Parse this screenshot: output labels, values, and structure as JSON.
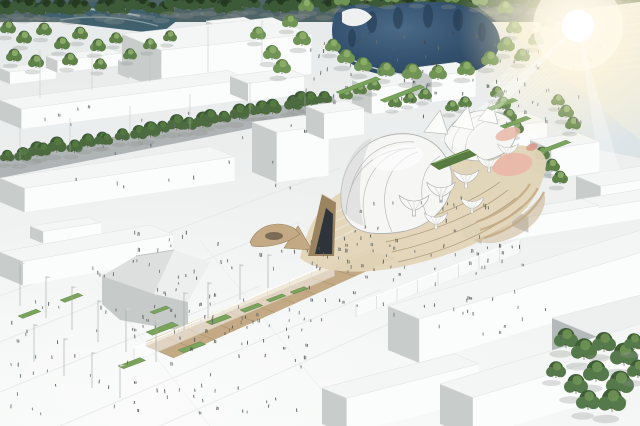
{
  "meta": {
    "title": "Aerial architectural rendering: expo masterplan with organic membrane-and-timber pavilion, pond and white massing buildings",
    "visible_text": []
  },
  "palette": {
    "groundTop": "#e9eceb",
    "groundBottom": "#f5f7f6",
    "backdrop": "#4f6468",
    "river": "#41606e",
    "pond": "#33516e",
    "pondDeep": "#22374d",
    "pondEdge": "#6d88a0",
    "faceTop": "#f4f6f5",
    "faceFront": "#fbfcfc",
    "faceSide": "#c8cdcc",
    "streetDark": "#7e8486",
    "wood": "#c3aa85",
    "woodDark": "#99845f",
    "woodLight": "#e2d4b6",
    "shell": "#f6f6f4",
    "shellLine": "#aeb2b0",
    "glassDark": "#26323e",
    "pink": "#e9b7a8",
    "pinkDark": "#d99485",
    "grass": "#7aa35b",
    "grassDark": "#567c41",
    "treeDark": "#2c432e",
    "tree": "#3d5a38",
    "treeMid": "#4c6b40",
    "treeLight": "#5d8148",
    "treeHi": "#8fb06a",
    "person": "#4a4e50",
    "sunGlow": "#fff3cf",
    "pole": "#9fa5a4"
  },
  "scene": {
    "seed": 11,
    "sun": {
      "x": 578,
      "y": 26
    },
    "tree_bands": [
      {
        "x1": 0,
        "y1": 15,
        "x2": 640,
        "y2": 6,
        "count": 56,
        "rmin": 7,
        "rmax": 12,
        "jy": 7,
        "colors": [
          "#2c432e",
          "#3d5a38",
          "#24381f"
        ]
      },
      {
        "x1": 6,
        "y1": 164,
        "x2": 334,
        "y2": 102,
        "count": 26,
        "rmin": 7,
        "rmax": 10,
        "jy": 4,
        "colors": [
          "#3d5a38",
          "#4c6b40",
          "#567c41"
        ]
      }
    ],
    "lawn_trees": [
      [
        8,
        34,
        8
      ],
      [
        24,
        44,
        8
      ],
      [
        44,
        36,
        8
      ],
      [
        62,
        50,
        8
      ],
      [
        80,
        40,
        8
      ],
      [
        98,
        52,
        8
      ],
      [
        116,
        44,
        7
      ],
      [
        14,
        62,
        8
      ],
      [
        36,
        68,
        8
      ],
      [
        70,
        66,
        8
      ],
      [
        100,
        70,
        7
      ],
      [
        130,
        60,
        7
      ],
      [
        150,
        50,
        7
      ],
      [
        170,
        42,
        7
      ]
    ],
    "pond_trees": [
      [
        333,
        52,
        8
      ],
      [
        346,
        64,
        9
      ],
      [
        363,
        72,
        9
      ],
      [
        386,
        77,
        9
      ],
      [
        412,
        80,
        10
      ],
      [
        438,
        80,
        9
      ],
      [
        466,
        76,
        9
      ],
      [
        490,
        66,
        9
      ],
      [
        506,
        52,
        9
      ],
      [
        514,
        34,
        8
      ],
      [
        505,
        14,
        8
      ],
      [
        480,
        6,
        8
      ],
      [
        452,
        3,
        8
      ],
      [
        420,
        2,
        8
      ],
      [
        392,
        3,
        8
      ],
      [
        366,
        2,
        8
      ],
      [
        342,
        6,
        8
      ],
      [
        302,
        46,
        9
      ],
      [
        290,
        28,
        8
      ],
      [
        306,
        12,
        8
      ],
      [
        272,
        60,
        9
      ],
      [
        258,
        40,
        8
      ],
      [
        282,
        74,
        9
      ],
      [
        522,
        62,
        8
      ],
      [
        536,
        46,
        8
      ],
      [
        548,
        28,
        8
      ]
    ],
    "roofline_trees": [
      [
        497,
        98,
        7
      ],
      [
        503,
        110,
        8
      ],
      [
        509,
        122,
        8
      ],
      [
        516,
        134,
        8
      ],
      [
        558,
        106,
        7
      ],
      [
        566,
        118,
        8
      ],
      [
        573,
        130,
        8
      ],
      [
        542,
        160,
        8
      ],
      [
        552,
        172,
        8
      ],
      [
        560,
        184,
        8
      ]
    ],
    "mid_trees": [
      [
        346,
        100,
        7
      ],
      [
        360,
        95,
        7
      ],
      [
        374,
        91,
        7
      ],
      [
        395,
        108,
        7
      ],
      [
        410,
        104,
        7
      ],
      [
        425,
        100,
        7
      ],
      [
        452,
        112,
        7
      ],
      [
        465,
        108,
        7
      ]
    ],
    "corner_trees": [
      [
        566,
        348,
        12
      ],
      [
        584,
        360,
        13
      ],
      [
        604,
        352,
        12
      ],
      [
        624,
        366,
        14
      ],
      [
        596,
        382,
        13
      ],
      [
        576,
        394,
        12
      ],
      [
        620,
        394,
        14
      ],
      [
        638,
        378,
        11
      ],
      [
        556,
        378,
        10
      ],
      [
        634,
        350,
        10
      ],
      [
        612,
        412,
        14
      ],
      [
        588,
        410,
        12
      ]
    ],
    "buildings_back": [
      [
        0,
        68,
        46,
        12,
        12,
        -0.12
      ],
      [
        46,
        56,
        64,
        14,
        12,
        -0.12
      ],
      [
        118,
        60,
        92,
        14,
        14,
        -0.12
      ],
      [
        176,
        30,
        28,
        16,
        13,
        -0.1
      ],
      [
        206,
        21,
        38,
        20,
        17,
        -0.1
      ],
      [
        122,
        34,
        150,
        48,
        40,
        -0.11
      ],
      [
        352,
        80,
        46,
        24,
        26,
        -0.13
      ],
      [
        412,
        68,
        44,
        24,
        26,
        -0.13
      ],
      [
        466,
        120,
        58,
        28,
        34,
        -0.15
      ],
      [
        530,
        140,
        48,
        26,
        30,
        -0.15
      ],
      [
        576,
        176,
        64,
        30,
        34,
        -0.15
      ],
      [
        0,
        100,
        228,
        26,
        20,
        -0.13
      ],
      [
        230,
        76,
        58,
        22,
        18,
        -0.13
      ]
    ],
    "buildings_front": [
      [
        252,
        122,
        52,
        30,
        50,
        -0.13
      ],
      [
        306,
        106,
        40,
        22,
        26,
        -0.13
      ],
      [
        0,
        178,
        210,
        30,
        24,
        -0.15
      ],
      [
        30,
        226,
        58,
        16,
        12,
        -0.15
      ],
      [
        0,
        252,
        150,
        28,
        24,
        -0.18
      ],
      [
        462,
        218,
        178,
        24,
        18,
        -0.16
      ],
      [
        512,
        210,
        70,
        20,
        16,
        -0.16
      ],
      [
        388,
        306,
        252,
        38,
        44,
        -0.3
      ],
      [
        552,
        318,
        120,
        55,
        50,
        -0.26,
        "gray"
      ],
      [
        322,
        388,
        132,
        30,
        36,
        -0.26
      ],
      [
        440,
        384,
        200,
        40,
        40,
        -0.3
      ]
    ],
    "street_band": [
      [
        0,
        158
      ],
      [
        332,
        96
      ],
      [
        344,
        110
      ],
      [
        0,
        178
      ]
    ],
    "grid_roof": {
      "poly": [
        [
          492,
          84
        ],
        [
          574,
          10
        ],
        [
          640,
          2
        ],
        [
          640,
          158
        ],
        [
          588,
          148
        ]
      ],
      "f1": {
        "fx": 574,
        "fy": 10,
        "tx": 640,
        "ty": 2,
        "n": 12,
        "dx": -120,
        "dy": 108
      },
      "f2": {
        "fx": 492,
        "fy": 84,
        "tx": 574,
        "ty": 10,
        "n": 10,
        "dx": 165,
        "dy": -20
      }
    },
    "axis": {
      "n1": [
        146,
        346
      ],
      "n2": [
        372,
        252
      ],
      "f1": [
        174,
        358
      ],
      "f2": [
        396,
        258
      ],
      "stripes": 11
    },
    "arcades": [
      {
        "ax": 134,
        "ay": 348,
        "bx": 334,
        "by": 262,
        "h": 14,
        "n": 9
      },
      {
        "ax": 356,
        "ay": 304,
        "bx": 520,
        "by": 240,
        "h": 13,
        "n": 8
      }
    ],
    "funnels": [
      [
        414,
        216,
        1.15
      ],
      [
        441,
        202,
        1.1
      ],
      [
        466,
        188,
        1.0
      ],
      [
        489,
        172,
        0.9
      ],
      [
        508,
        158,
        0.8
      ],
      [
        436,
        229,
        0.9
      ],
      [
        472,
        213,
        0.88
      ]
    ],
    "grass": [
      [
        146,
        332,
        26,
        8
      ],
      [
        178,
        350,
        22,
        7
      ],
      [
        206,
        322,
        20,
        7
      ],
      [
        240,
        310,
        18,
        6
      ],
      [
        266,
        300,
        16,
        5
      ],
      [
        118,
        366,
        22,
        7
      ],
      [
        150,
        312,
        16,
        5
      ],
      [
        290,
        292,
        14,
        5
      ],
      [
        60,
        300,
        18,
        6
      ],
      [
        18,
        316,
        18,
        6
      ],
      [
        487,
        108,
        26,
        6
      ],
      [
        500,
        126,
        26,
        6
      ],
      [
        540,
        150,
        26,
        6
      ],
      [
        336,
        92,
        40,
        6
      ],
      [
        380,
        100,
        40,
        6
      ]
    ],
    "poles": [
      [
        20,
        306,
        44
      ],
      [
        46,
        318,
        42
      ],
      [
        72,
        330,
        44
      ],
      [
        98,
        342,
        42
      ],
      [
        126,
        352,
        44
      ],
      [
        156,
        362,
        42
      ],
      [
        34,
        362,
        38
      ],
      [
        64,
        376,
        38
      ],
      [
        92,
        388,
        36
      ],
      [
        120,
        398,
        34
      ],
      [
        184,
        330,
        38
      ],
      [
        208,
        318,
        36
      ],
      [
        240,
        300,
        36
      ],
      [
        268,
        288,
        34
      ]
    ],
    "masts": [
      [
        40,
        98,
        48
      ],
      [
        92,
        90,
        46
      ],
      [
        150,
        82,
        46
      ],
      [
        208,
        72,
        46
      ],
      [
        262,
        64,
        44
      ],
      [
        20,
        168,
        40
      ],
      [
        70,
        158,
        40
      ],
      [
        130,
        146,
        40
      ],
      [
        190,
        134,
        40
      ],
      [
        250,
        122,
        40
      ],
      [
        305,
        112,
        36
      ]
    ],
    "crowds": [
      [
        8,
        298,
        310,
        118,
        90
      ],
      [
        140,
        252,
        210,
        84,
        46
      ],
      [
        330,
        246,
        200,
        62,
        38
      ],
      [
        332,
        198,
        170,
        54,
        26
      ],
      [
        300,
        238,
        110,
        34,
        14
      ],
      [
        295,
        34,
        250,
        86,
        58
      ],
      [
        518,
        22,
        96,
        50,
        22
      ],
      [
        15,
        102,
        290,
        90,
        26
      ],
      [
        385,
        298,
        185,
        42,
        16
      ],
      [
        90,
        232,
        130,
        56,
        18
      ],
      [
        505,
        88,
        85,
        40,
        14
      ]
    ]
  }
}
